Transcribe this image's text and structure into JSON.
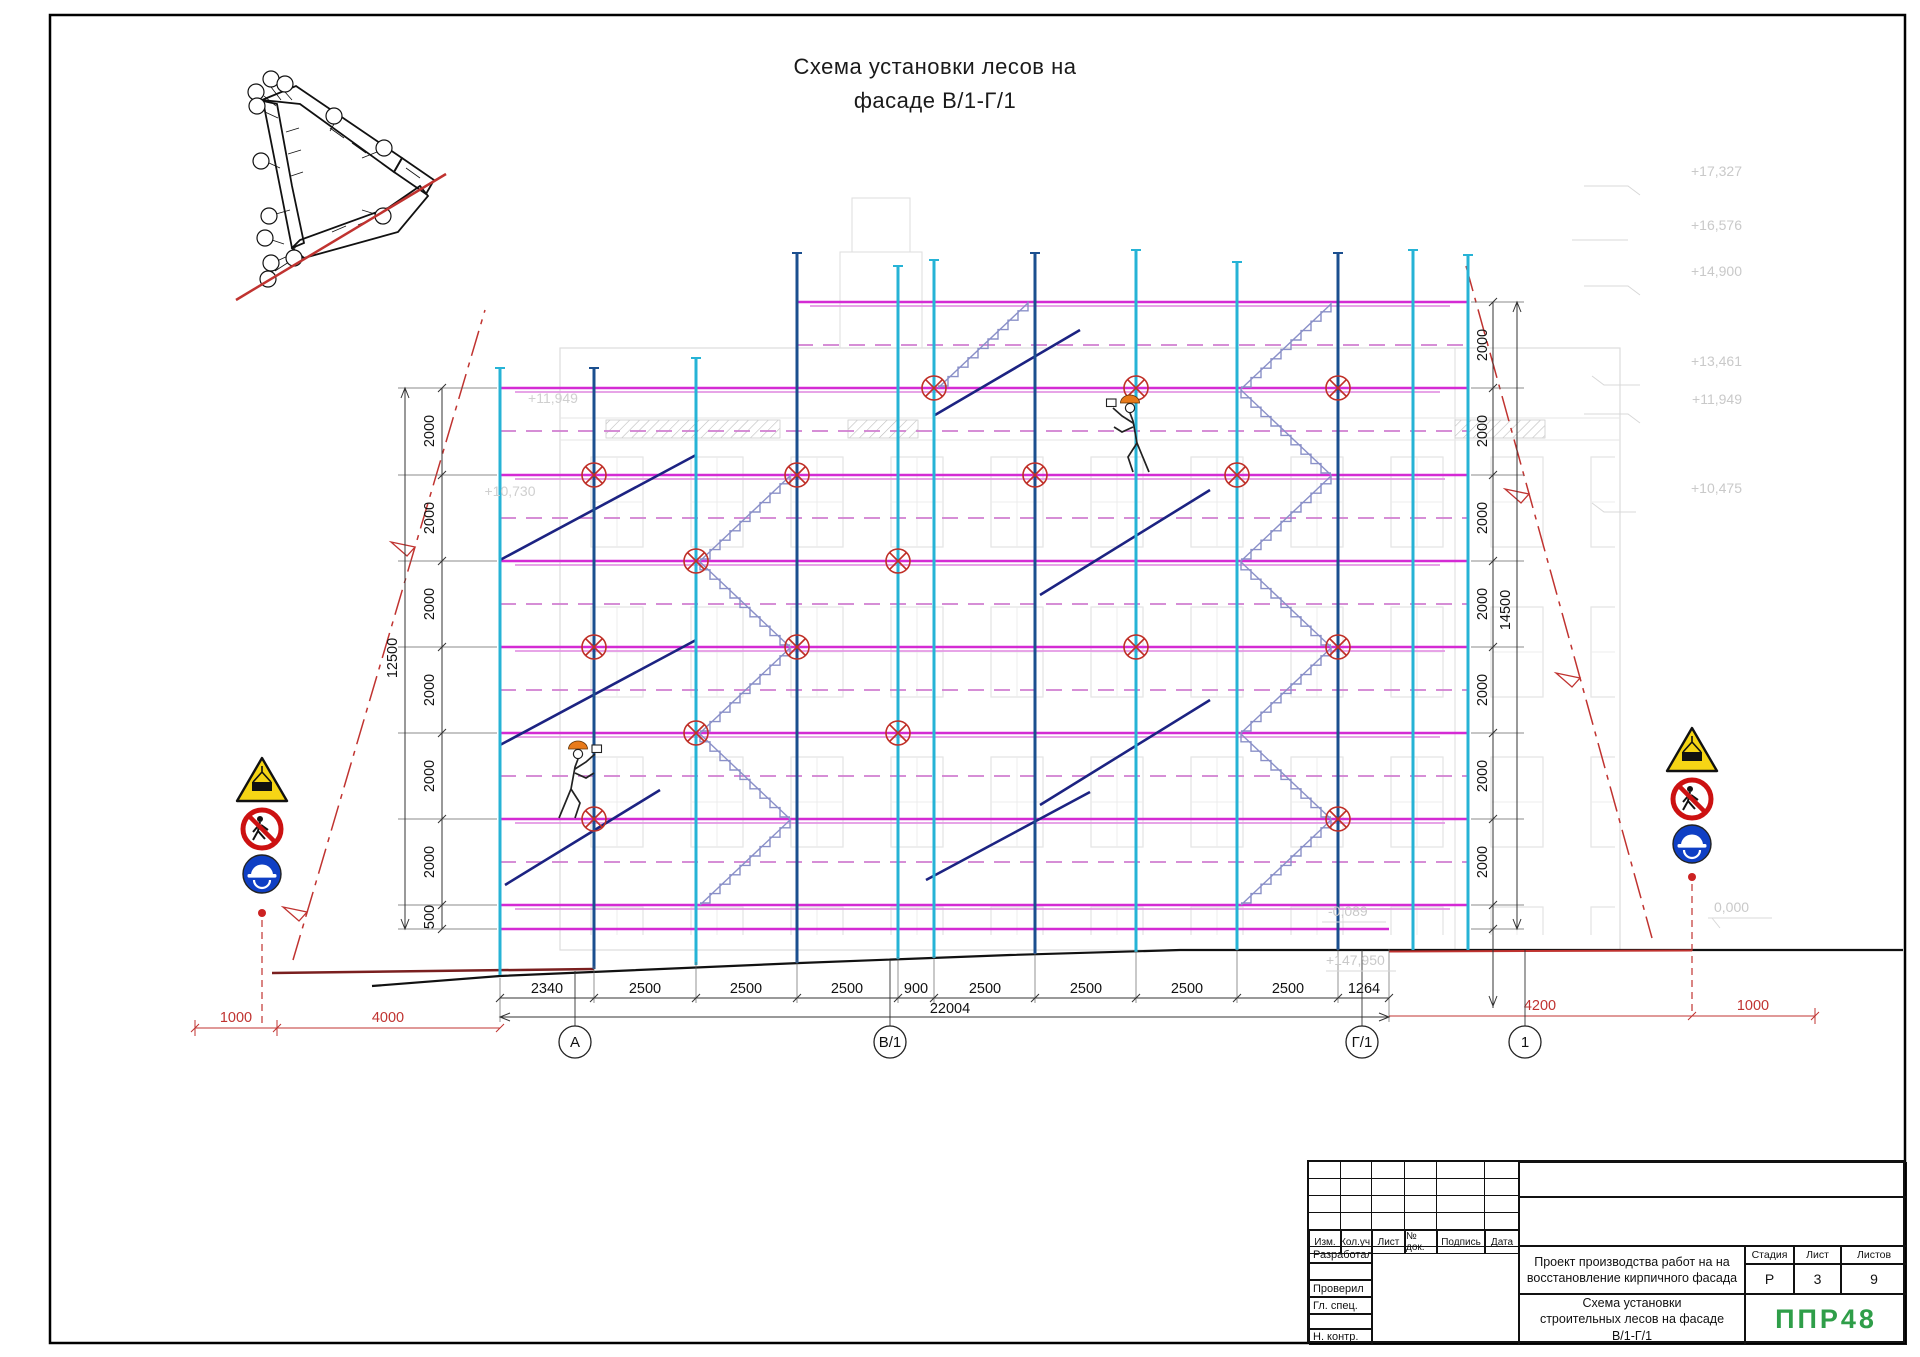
{
  "title": {
    "line1": "Схема установки лесов на",
    "line2": "фасаде В/1-Г/1"
  },
  "dims": {
    "left": {
      "s": [
        "2000",
        "2000",
        "2000",
        "2000",
        "2000",
        "2000",
        "500"
      ],
      "total": "12500"
    },
    "right": {
      "s": [
        "2000",
        "2000",
        "2000",
        "2000",
        "2000",
        "2000",
        "2000"
      ],
      "total": "14500"
    },
    "bottom": {
      "s": [
        "2340",
        "2500",
        "2500",
        "2500",
        "900",
        "2500",
        "2500",
        "2500",
        "2500",
        "1264"
      ],
      "total": "22004"
    },
    "red": {
      "left": [
        "1000",
        "4000"
      ],
      "right": [
        "4200",
        "1000"
      ]
    }
  },
  "levels": {
    "right": [
      "+17,327",
      "+16,576",
      "+14,900",
      "+13,461",
      "+11,949",
      "+10,475"
    ],
    "left": [
      "+11,949",
      "+10,730"
    ],
    "ground": [
      "-0,089",
      "+147,950",
      "0,000"
    ]
  },
  "axes": [
    "А",
    "В/1",
    "Г/1",
    "1"
  ],
  "signs": {
    "warning": "falling-load-warning",
    "prohibition": "no-pedestrians",
    "mandatory": "wear-hard-hat"
  },
  "title_block": {
    "cols": [
      "Изм.",
      "Кол.уч.",
      "Лист",
      "№ док.",
      "Подпись",
      "Дата"
    ],
    "staff": [
      "Разработал",
      "Проверил",
      "Гл. спец.",
      "Н. контр."
    ],
    "project_line1": "Проект производства работ на на",
    "project_line2": "восстановление кирпичного фасада",
    "doc_line1": "Схема установки",
    "doc_line2": "строительных лесов на фасаде",
    "doc_line3": "В/1-Г/1",
    "stage_label": "Стадия",
    "sheet_label": "Лист",
    "sheets_label": "Листов",
    "stage": "Р",
    "sheet": "3",
    "sheets": "9",
    "logo": "ППР48"
  },
  "colors": {
    "post_cyan": "#26b3d6",
    "post_blue": "#1b4f8f",
    "rail": "#d42bd4",
    "rail_light": "#e394e3",
    "brace": "#1c2382",
    "stairs": "#8a90c8",
    "anchor": "#c03028",
    "red": "#c03330",
    "logo_green": "#2f9e49"
  }
}
